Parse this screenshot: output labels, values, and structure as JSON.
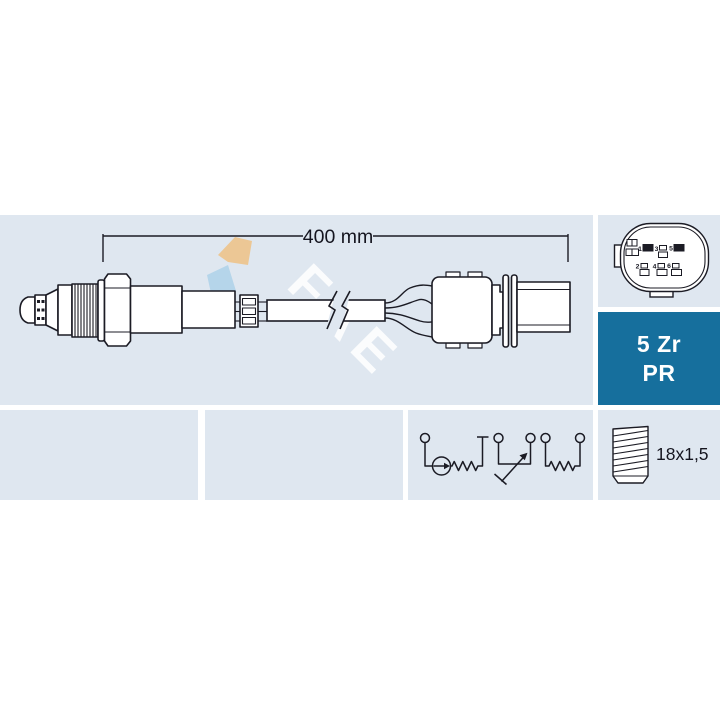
{
  "drawing": {
    "dimension_label": "400 mm"
  },
  "watermark": {
    "text": "FAE"
  },
  "connector_pinout": {
    "pin_labels": {
      "p1": "1",
      "p3": "3",
      "p5": "5",
      "p2": "2",
      "p4": "4",
      "p6": "6"
    }
  },
  "spec_badge": {
    "line1": "5 Zr",
    "line2": "PR"
  },
  "thread_spec": {
    "label": "18x1,5"
  },
  "colors": {
    "panel_bg": "#dfe7f0",
    "badge_bg": "#166f9d",
    "badge_text": "#ffffff",
    "line": "#1b1b24",
    "logo_tan": "#ecc795",
    "logo_blue": "#b5d5ea",
    "watermark_text": "#ffffff"
  }
}
